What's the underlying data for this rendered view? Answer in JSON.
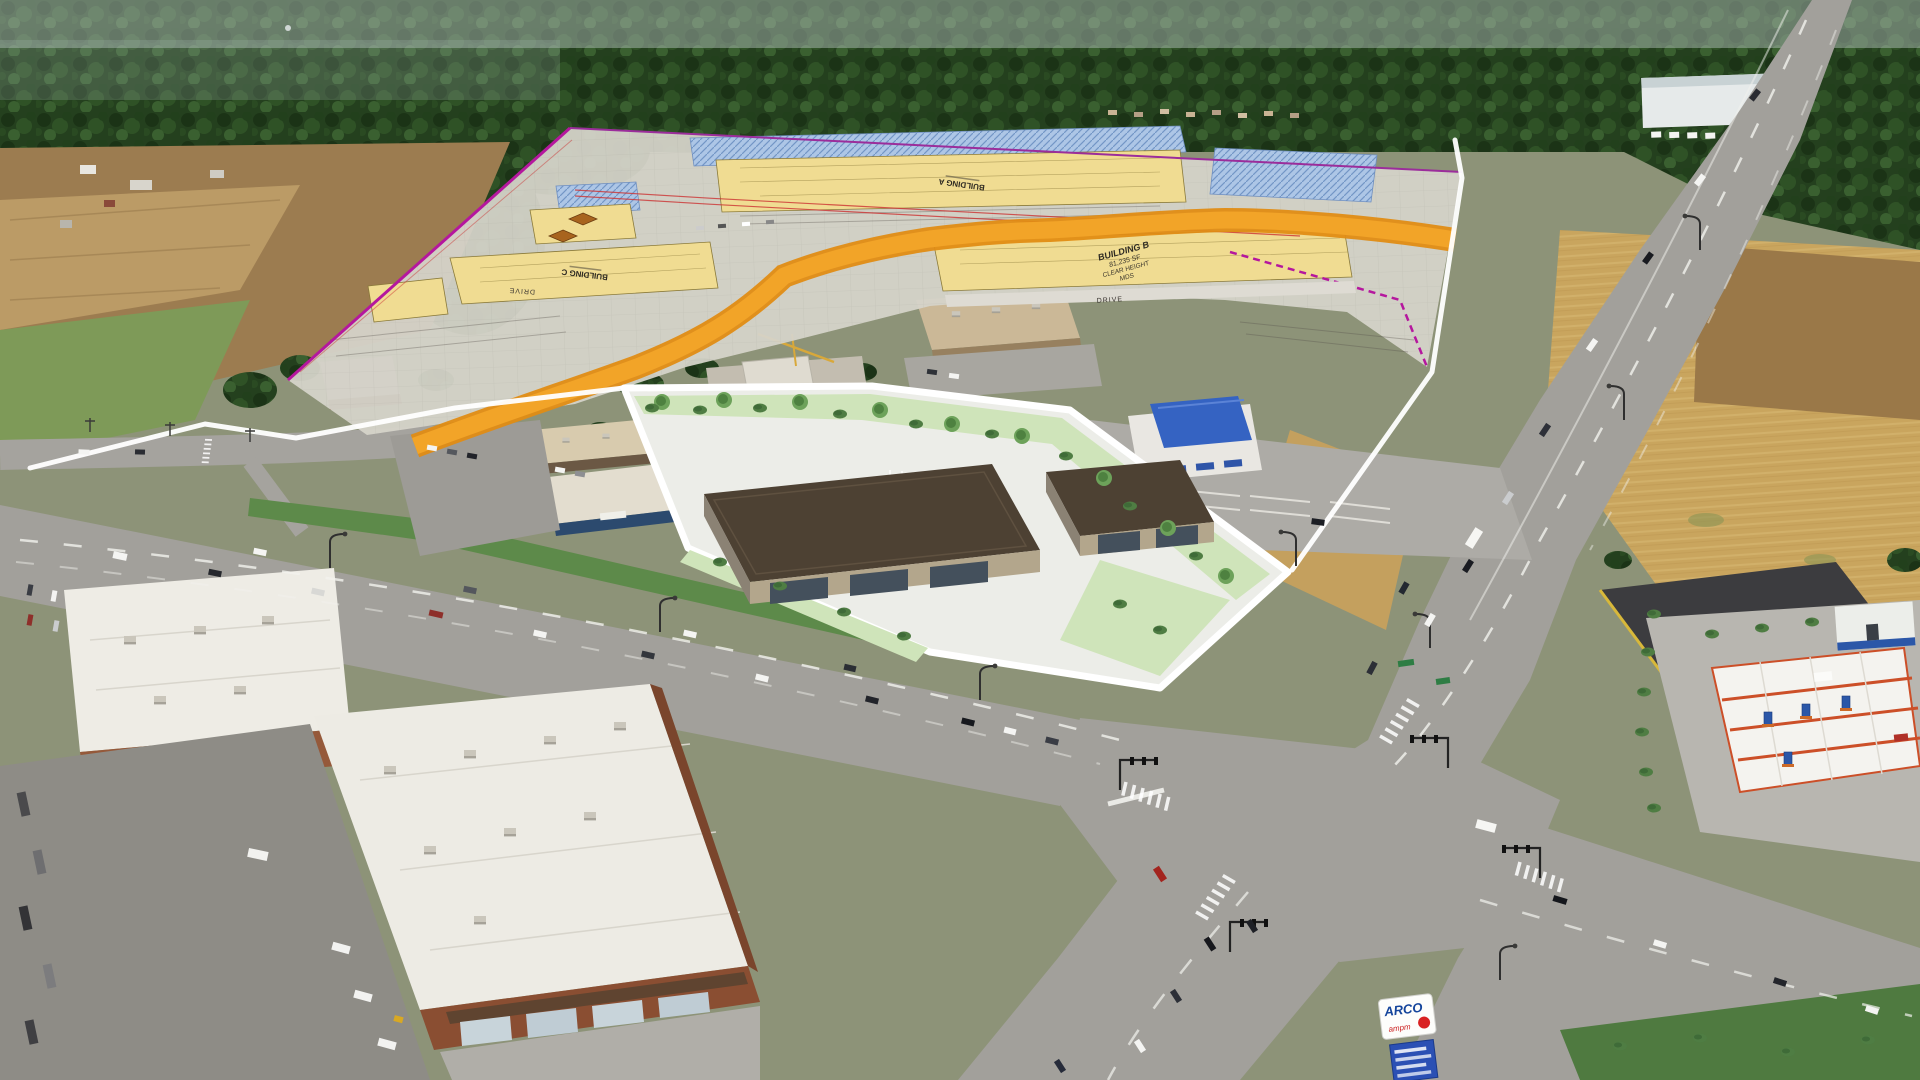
{
  "scene": {
    "type": "aerial-drone-photograph",
    "description": "Daytime aerial view of a commercial development site beside a multi-lane highway intersection, surrounded by evergreen forest, farm fields and existing retail buildings. An engineering site plan and a 3D building rendering are overlaid on the photo.",
    "features": [
      "evergreen forest",
      "farm fields",
      "site plan overlay",
      "rendered retail buildings",
      "signalized intersection",
      "gas station",
      "brick retail centers",
      "dry grass fields"
    ]
  },
  "site_plan_overlay": {
    "sheet_color": "#d6d3ca",
    "labels": {
      "building_a": "BUILDING A",
      "building_b": {
        "line1": "BUILDING B",
        "line2": "81,235 SF",
        "line3": "CLEAR HEIGHT",
        "line4": "MDS"
      },
      "building_c": "BUILDING C",
      "drive_west": "DRIVE",
      "drive_east": "DRIVE"
    },
    "colors": {
      "footprint_yellow": "#f0dc92",
      "parking_hatch_blue": "#adc6e6",
      "proposed_drive_orange": "#f2a428",
      "boundary_magenta": "#b5179e",
      "centerline_red": "#cc3333",
      "property_line_white": "#ffffff"
    }
  },
  "rendered_site": {
    "buildings": 2,
    "landscape_green": "#cfe4ba",
    "roof_brown": "#4d4133",
    "wall_tan": "#b3a68c",
    "paving_white": "#ecede8"
  },
  "gas_station": {
    "brand": "ARCO",
    "sub_brand": "ampm",
    "sign": {
      "panel": "#fdfdfb",
      "brand_text": "#15459c",
      "spark": "#d92121",
      "price_panel": "#2b50b4"
    },
    "canopy": {
      "deck": "#f4f3ef",
      "beams": "#cc4f28",
      "pumps": "#2b57a8"
    }
  },
  "environment": {
    "forest_green": "#24401e",
    "dry_grass": "#c9a55e",
    "plowed_field": "#9a7848",
    "asphalt": "#a2a09b"
  }
}
